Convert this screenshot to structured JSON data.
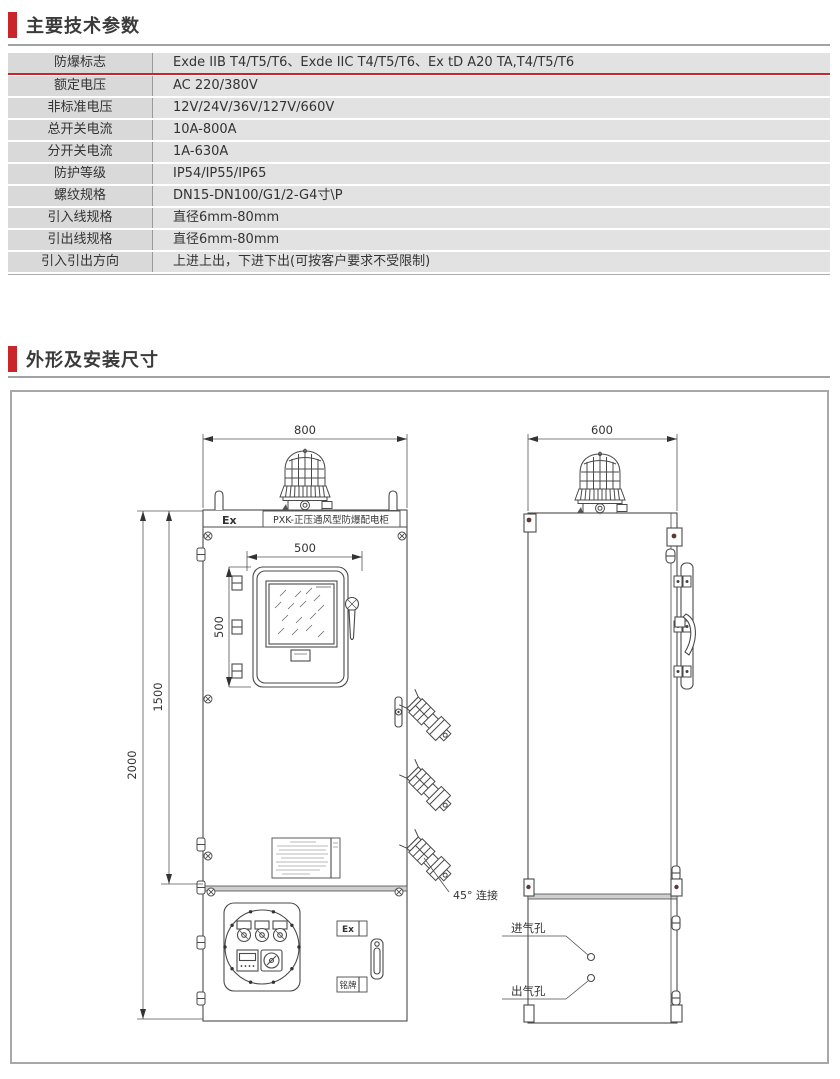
{
  "accent_red": "#c9252b",
  "sections": [
    {
      "title": "主要技术参数"
    },
    {
      "title": "外形及安装尺寸"
    }
  ],
  "params": {
    "rows": [
      {
        "label": "防爆标志",
        "value": "Exde IIB T4/T5/T6、Exde IIC T4/T5/T6、Ex tD A20 TA,T4/T5/T6"
      },
      {
        "label": "额定电压",
        "value": "AC 220/380V"
      },
      {
        "label": "非标准电压",
        "value": "12V/24V/36V/127V/660V"
      },
      {
        "label": "总开关电流",
        "value": "10A-800A"
      },
      {
        "label": "分开关电流",
        "value": "1A-630A"
      },
      {
        "label": "防护等级",
        "value": "IP54/IP55/IP65"
      },
      {
        "label": "螺纹规格",
        "value": "DN15-DN100/G1/2-G4寸\\P"
      },
      {
        "label": "引入线规格",
        "value": "直径6mm-80mm"
      },
      {
        "label": "引出线规格",
        "value": "直径6mm-80mm"
      },
      {
        "label": "引入引出方向",
        "value": "上进上出，下进下出(可按客户要求不受限制)"
      }
    ]
  },
  "drawing": {
    "front": {
      "width_mm": "800",
      "window_w_mm": "500",
      "window_h_mm": "500",
      "body_h_mm": "1500",
      "total_h_mm": "2000",
      "ex_label": "Ex",
      "cabinet_name": "PXK-正压通风型防爆配电柜",
      "ex_small": "Ex",
      "nameplate_label": "铭牌",
      "connector_note": "45° 连接"
    },
    "side": {
      "depth_mm": "600",
      "inlet_label": "进气孔",
      "outlet_label": "出气孔"
    }
  }
}
